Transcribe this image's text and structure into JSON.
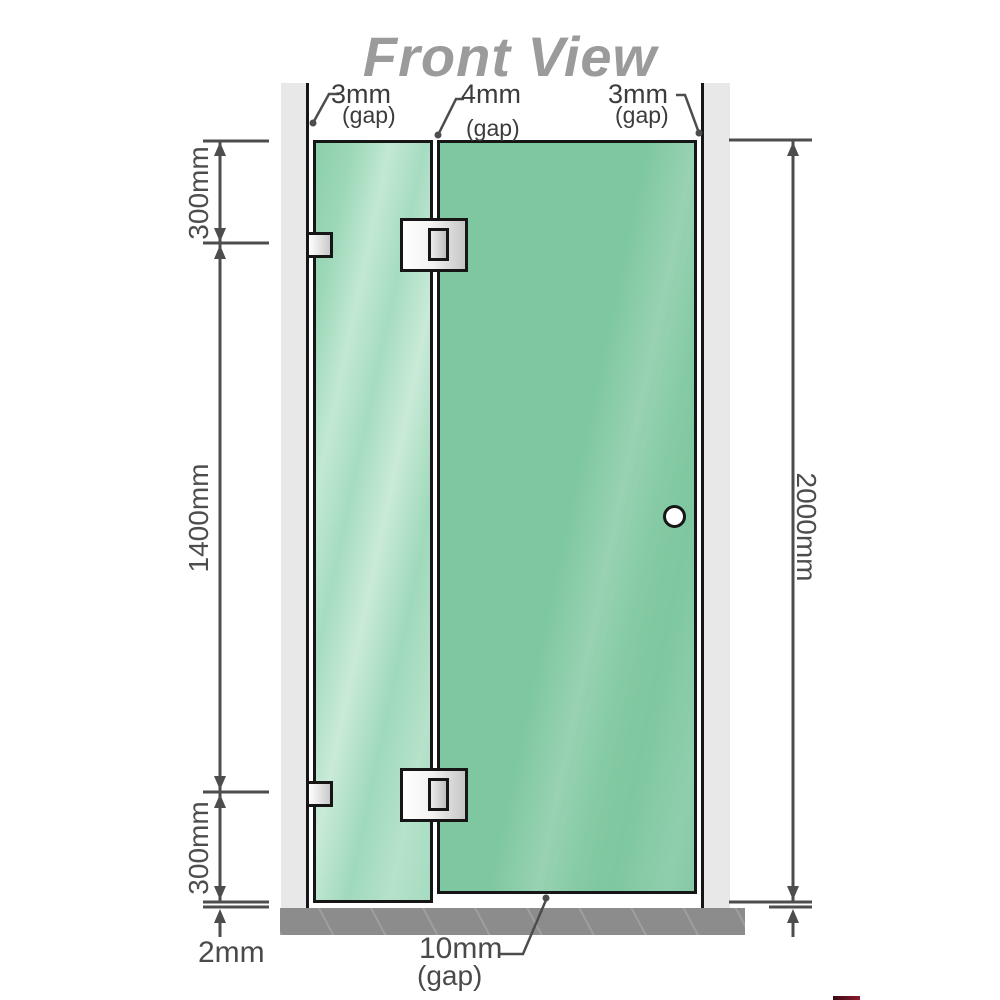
{
  "title": "Front View",
  "labels": {
    "gap_left": {
      "value": "3mm",
      "suffix": "(gap)"
    },
    "gap_middle": {
      "value": "4mm",
      "suffix": "(gap)"
    },
    "gap_right": {
      "value": "3mm",
      "suffix": "(gap)"
    },
    "dim_top_segment": "300mm",
    "dim_middle_segment": "1400mm",
    "dim_bottom_segment": "300mm",
    "dim_total_height": "2000mm",
    "dim_floor_clearance": "2mm",
    "gap_bottom": {
      "value": "10mm",
      "suffix": "(gap)"
    }
  },
  "colors": {
    "glass_green": "#7ec7a0",
    "glass_green_light": "#a6dcc1",
    "wall_gray": "#e8e8e8",
    "floor_gray": "#8c8c8c",
    "dimension_gray": "#4d4d4d",
    "title_gray": "#9b9b9b",
    "outline_black": "#161616"
  }
}
